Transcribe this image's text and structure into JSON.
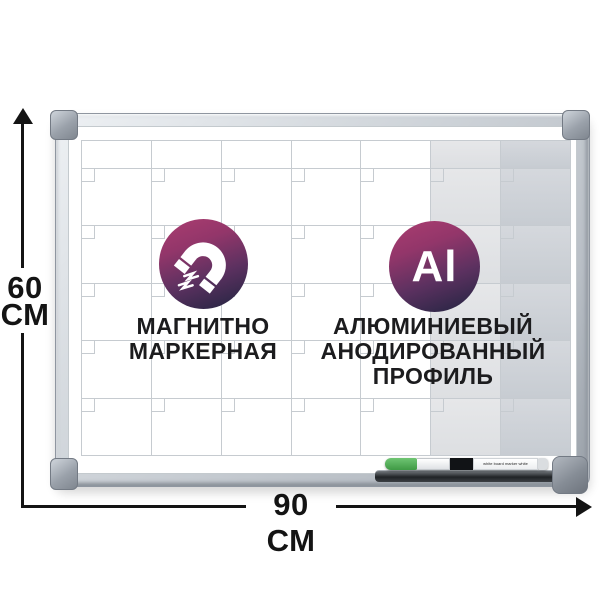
{
  "dimensions": {
    "height_value": "60",
    "height_unit": "СМ",
    "width_label": "90 СМ"
  },
  "features": {
    "magnetic": {
      "icon": "magnet-icon",
      "line1": "МАГНИТНО",
      "line2": "МАРКЕРНАЯ"
    },
    "aluminum": {
      "badge_text": "Al",
      "line1": "АЛЮМИНИЕВЫЙ",
      "line2": "АНОДИРОВАННЫЙ",
      "line3": "ПРОФИЛЬ"
    }
  },
  "marker": {
    "label": "white board marker white",
    "cap_color": "#4caf50"
  },
  "board": {
    "grid": {
      "columns": 7,
      "rows": 5,
      "header_row": true,
      "shaded_columns": [
        5,
        6
      ]
    }
  },
  "colors": {
    "badge_gradient_start": "#ab3d70",
    "badge_gradient_end": "#33284a",
    "dimension_line": "#141414",
    "grid_line": "#c6cbd0",
    "frame_silver": "#c3c9cf",
    "shaded_column_light": "#e2e3e5",
    "shaded_column_dark": "#ccd0d6"
  }
}
